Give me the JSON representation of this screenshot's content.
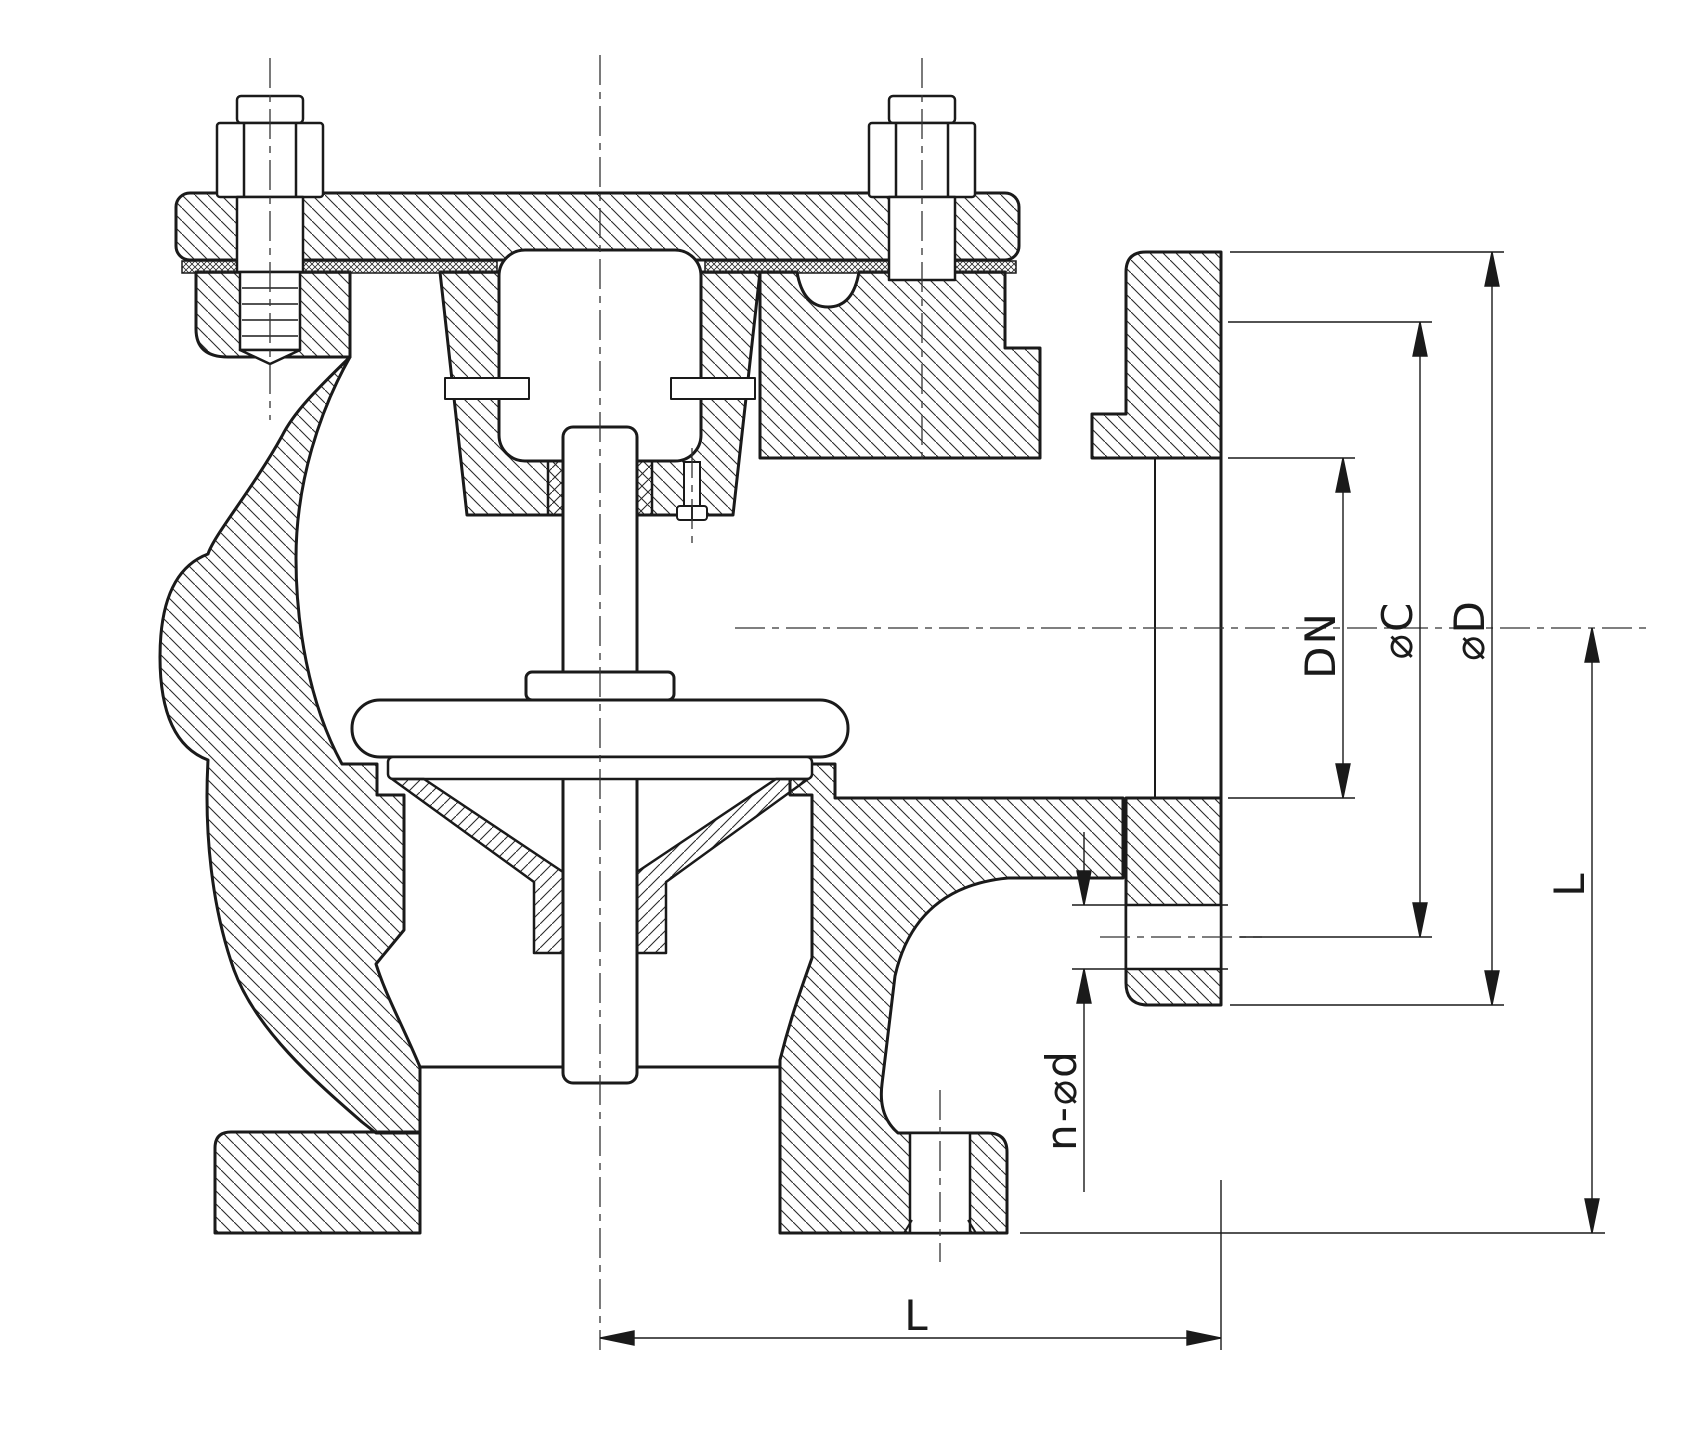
{
  "drawing": {
    "type": "valve-cross-section",
    "colors": {
      "background": "#ffffff",
      "line": "#1a1a1a",
      "hatch": "#2a2a2a"
    },
    "dimensions": {
      "bore": {
        "label": "DN"
      },
      "bolt_circle": {
        "label": "⌀C"
      },
      "flange_od": {
        "label": "⌀D"
      },
      "bolt_holes": {
        "label": "n-⌀d"
      },
      "face_to_center": {
        "label": "L"
      },
      "center_to_base": {
        "label": "L"
      }
    }
  }
}
